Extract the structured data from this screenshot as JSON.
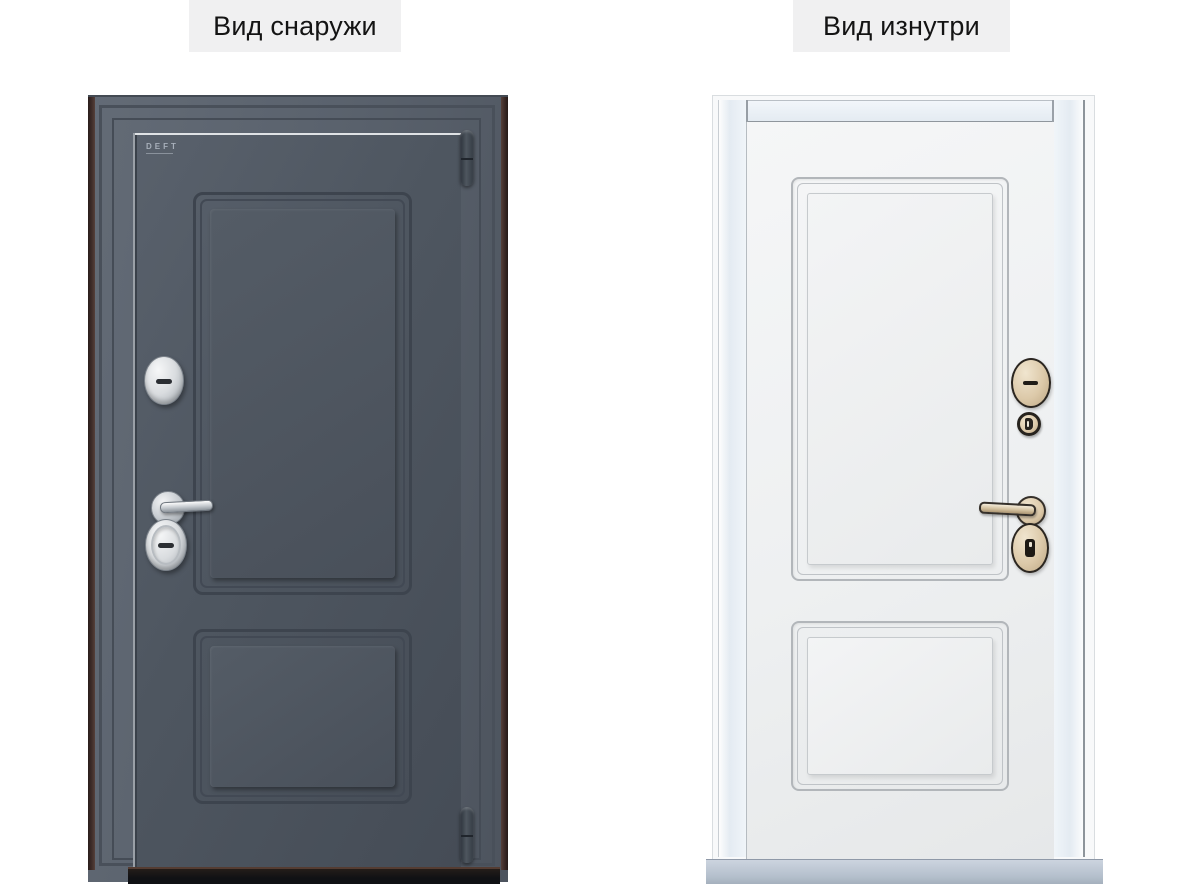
{
  "labels": {
    "outside_view": "Вид снаружи",
    "inside_view": "Вид изнутри"
  },
  "brand": {
    "logo_text": "DEFT"
  },
  "doors": {
    "outside": {
      "view_label": "Вид снаружи",
      "leaf_color": "#4e5660",
      "frame_color": "#5a626d",
      "edge_color": "#3f2d2a",
      "hardware_finish": "chrome",
      "hardware": [
        "cylinder-escutcheon",
        "lever-handle",
        "keyhole-escutcheon"
      ],
      "hinge_count": 2
    },
    "inside": {
      "view_label": "Вид изнутри",
      "leaf_color": "#eef0f1",
      "frame_color": "#e4ebf2",
      "threshold_color": "#b4bfcc",
      "hardware_finish": "champagne",
      "hardware": [
        "cylinder-escutcheon",
        "thumb-turn",
        "lever-handle",
        "keyhole-escutcheon"
      ]
    }
  },
  "theme": {
    "chip_bg": "#f0f0f1",
    "label_color": "#141414",
    "ld_leaf": "#4e5660",
    "ld_frame": "#5a626d",
    "ld_edge": "#3f2d2a",
    "ld_line": "#3d444e",
    "chrome_hi": "#f6f7f8",
    "chrome_lo": "#9aa1a8",
    "rd_leaf": "#eef0f1",
    "rd_frame": "#e4ebf2",
    "rd_line": "#b2b6ba",
    "champagne": "#dcc9a9",
    "champagne_dark": "#2b2620",
    "threshold": "#b4bfcc"
  }
}
